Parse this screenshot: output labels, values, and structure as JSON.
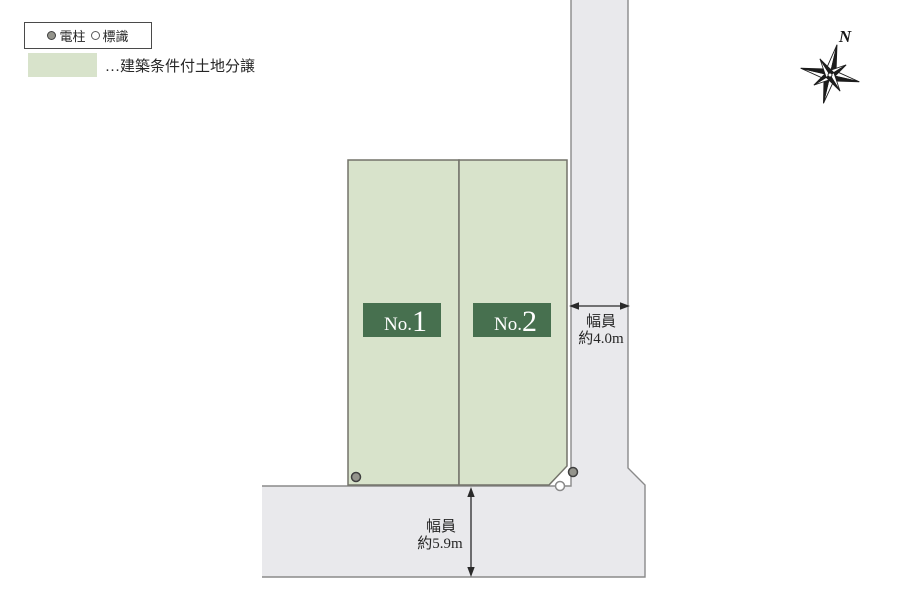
{
  "colors": {
    "plot_fill": "#d8e3cb",
    "plot_border": "#73736a",
    "plot_label_bg": "#47704f",
    "road_fill": "#e9e9ec",
    "road_border": "#8a8a8a"
  },
  "legend": {
    "pole_label": "電柱",
    "sign_label": "標識",
    "area_label": "…建築条件付土地分譲"
  },
  "compass": {
    "north_label": "N"
  },
  "plots": [
    {
      "name": "No.1",
      "prefix": "No.",
      "number": "1"
    },
    {
      "name": "No.2",
      "prefix": "No.",
      "number": "2"
    }
  ],
  "dimensions": {
    "east_road": {
      "line1": "幅員",
      "line2": "約4.0m"
    },
    "south_road": {
      "line1": "幅員",
      "line2": "約5.9m"
    }
  }
}
